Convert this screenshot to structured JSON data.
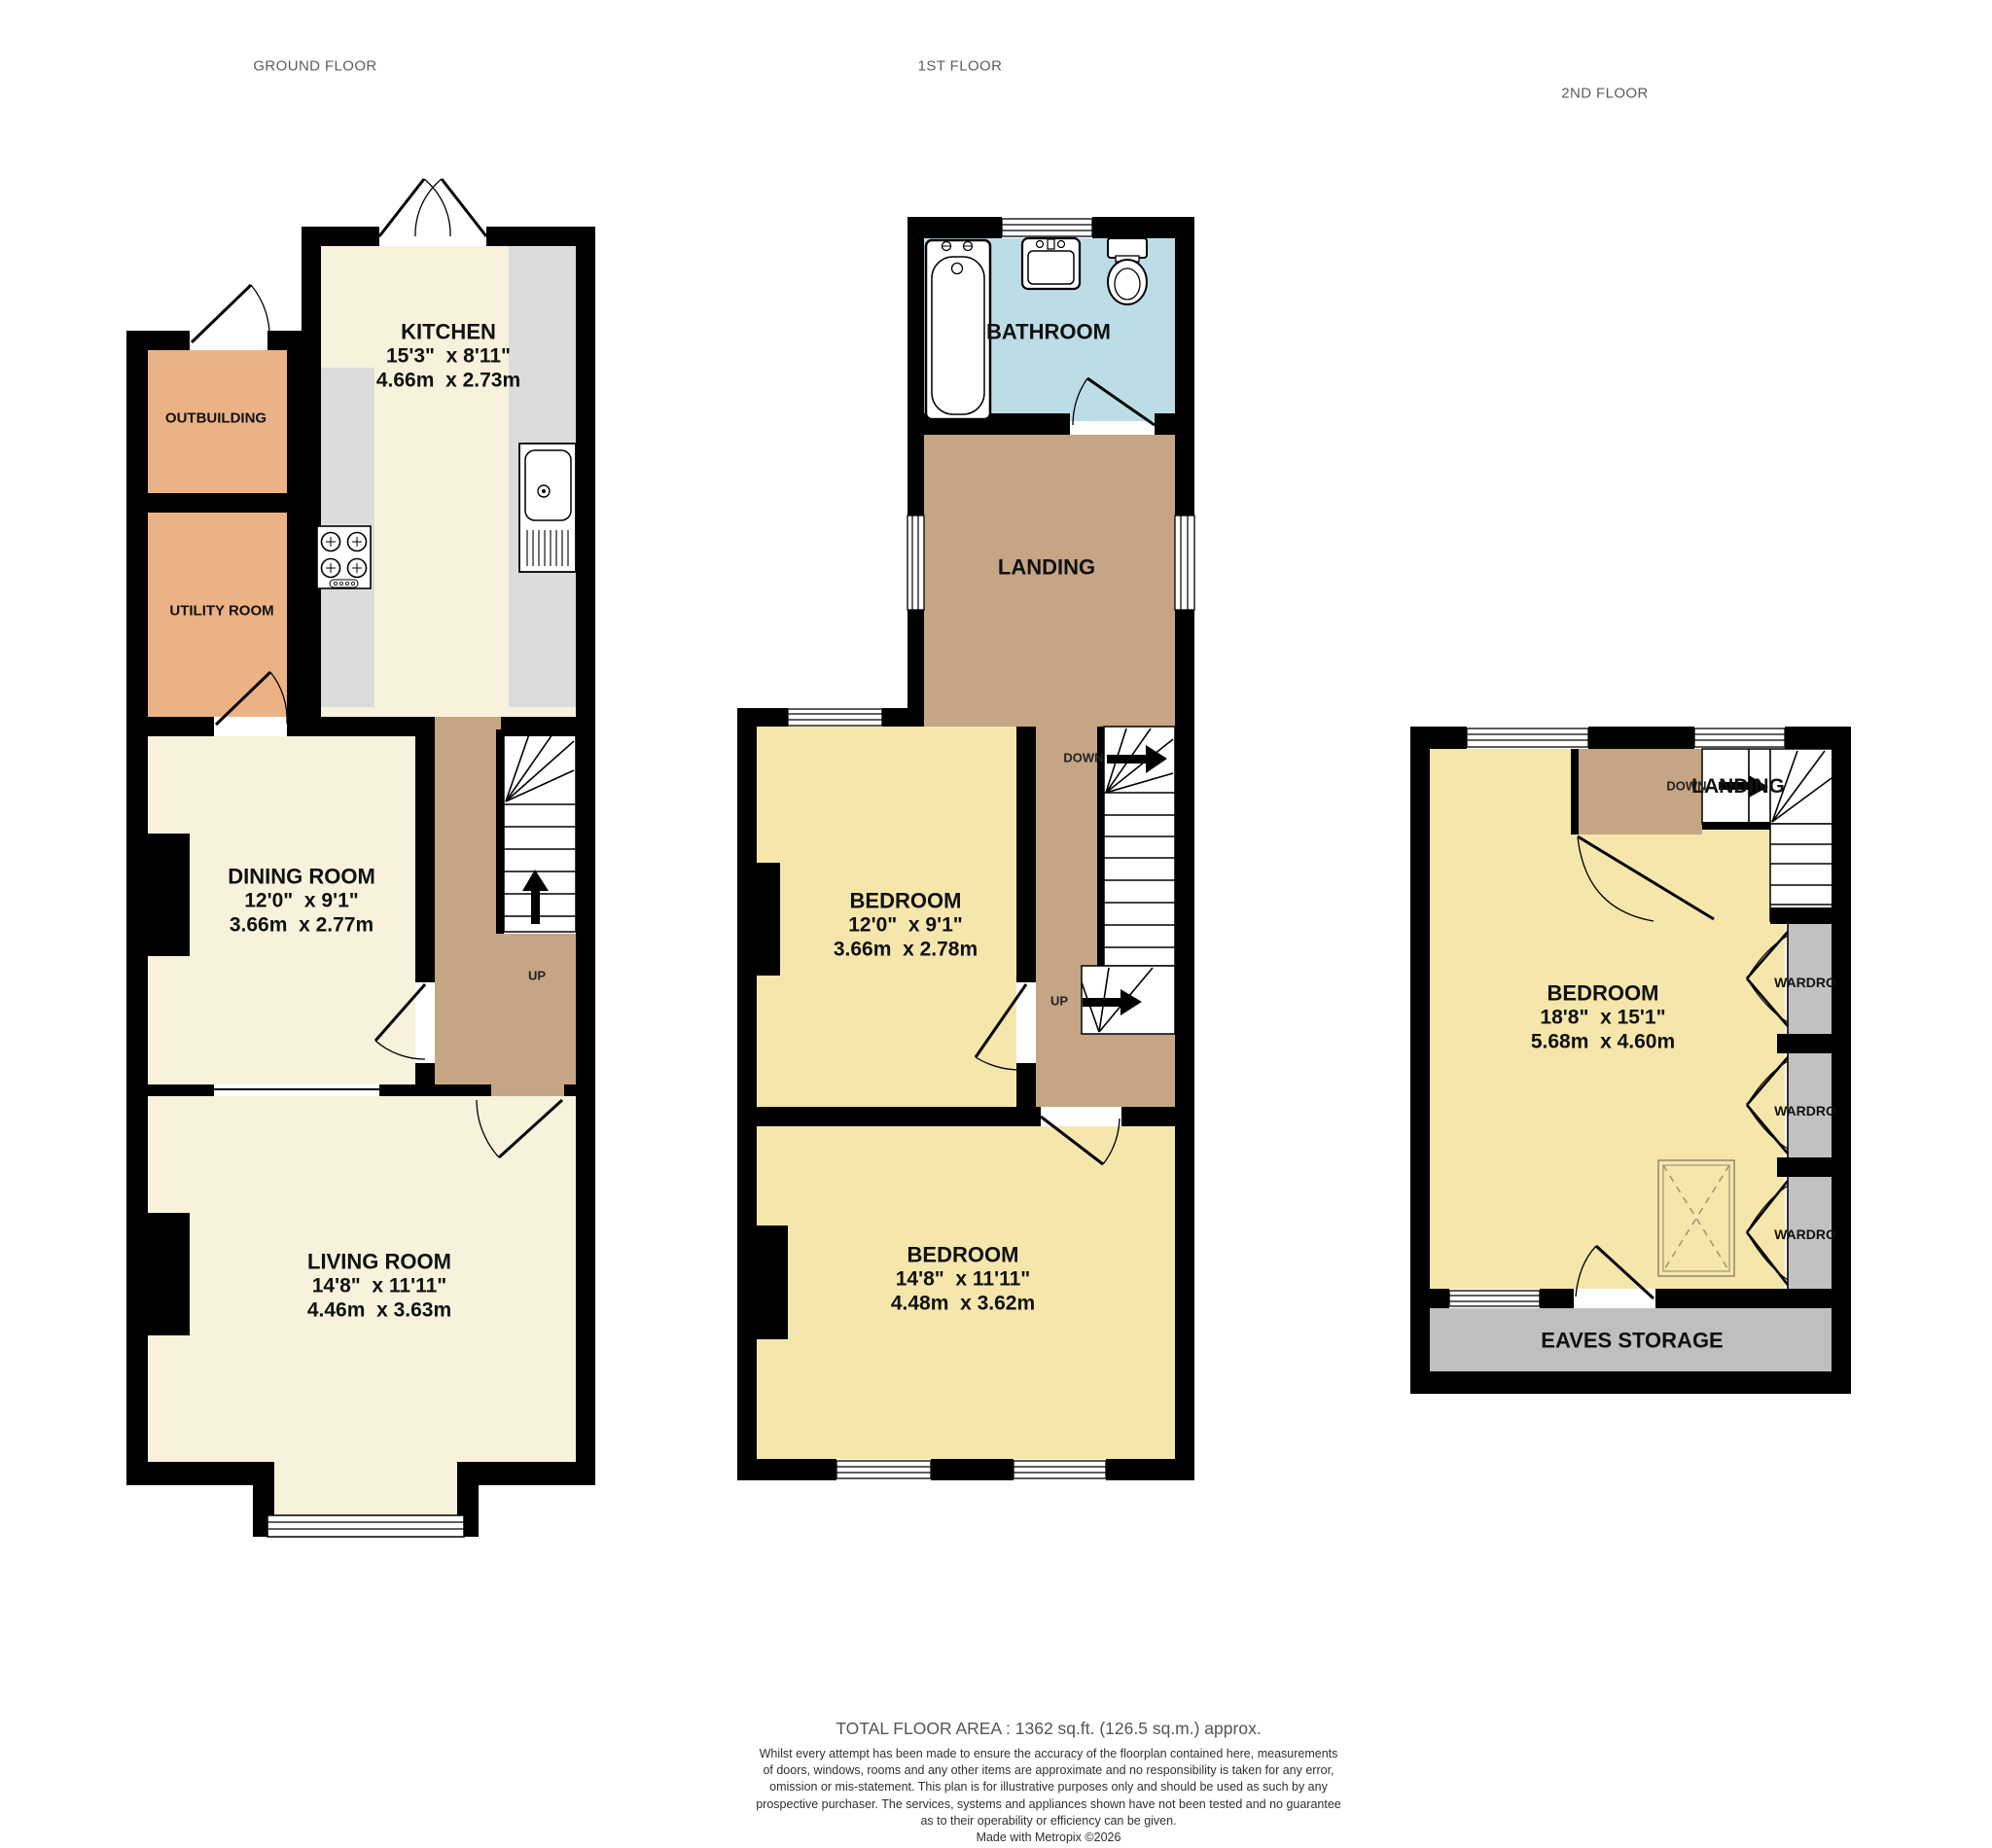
{
  "palette": {
    "wall": "#000000",
    "cream_floor": "#f8f2dc",
    "bedroom_yellow": "#f5e6ab",
    "outbuilding_orange": "#eab285",
    "landing_brown": "#c5a584",
    "bathroom_blue": "#bcdde6",
    "counter_gray": "#dcdcdc",
    "storage_gray": "#c1c1c1"
  },
  "floors": {
    "ground": {
      "title": "GROUND FLOOR",
      "kitchen": {
        "name": "KITCHEN",
        "imperial": "15'3\"  x 8'11\"",
        "metric": "4.66m  x 2.73m"
      },
      "outbuilding": {
        "name": "OUTBUILDING"
      },
      "utility": {
        "name": "UTILITY ROOM"
      },
      "dining": {
        "name": "DINING ROOM",
        "imperial": "12'0\"  x 9'1\"",
        "metric": "3.66m  x 2.77m"
      },
      "living": {
        "name": "LIVING ROOM",
        "imperial": "14'8\"  x 11'11\"",
        "metric": "4.46m  x 3.63m"
      },
      "up_label": "UP"
    },
    "first": {
      "title": "1ST FLOOR",
      "bathroom": {
        "name": "BATHROOM"
      },
      "landing": {
        "name": "LANDING"
      },
      "bedroom1": {
        "name": "BEDROOM",
        "imperial": "12'0\"  x 9'1\"",
        "metric": "3.66m  x 2.78m"
      },
      "bedroom2": {
        "name": "BEDROOM",
        "imperial": "14'8\"  x 11'11\"",
        "metric": "4.48m  x 3.62m"
      },
      "down_label": "DOWN",
      "up_label": "UP"
    },
    "second": {
      "title": "2ND FLOOR",
      "landing": {
        "name": "LANDING"
      },
      "bedroom": {
        "name": "BEDROOM",
        "imperial": "18'8\"  x 15'1\"",
        "metric": "5.68m  x 4.60m"
      },
      "wardrobes": [
        "WARDRO",
        "WARDRO",
        "WARDRO"
      ],
      "eaves": {
        "name": "EAVES STORAGE"
      },
      "down_label": "DOWN"
    }
  },
  "footer": {
    "total_area": "TOTAL FLOOR AREA : 1362 sq.ft. (126.5 sq.m.) approx.",
    "disclaimer_lines": [
      "Whilst every attempt has been made to ensure the accuracy of the floorplan contained here, measurements",
      "of doors, windows, rooms and any other items are approximate and no responsibility is taken for any error,",
      "omission or mis-statement. This plan is for illustrative purposes only and should be used as such by any",
      "prospective purchaser. The services, systems and appliances shown have not been tested and no guarantee",
      "as to their operability or efficiency can be given."
    ],
    "credit": "Made with Metropix ©2026"
  }
}
